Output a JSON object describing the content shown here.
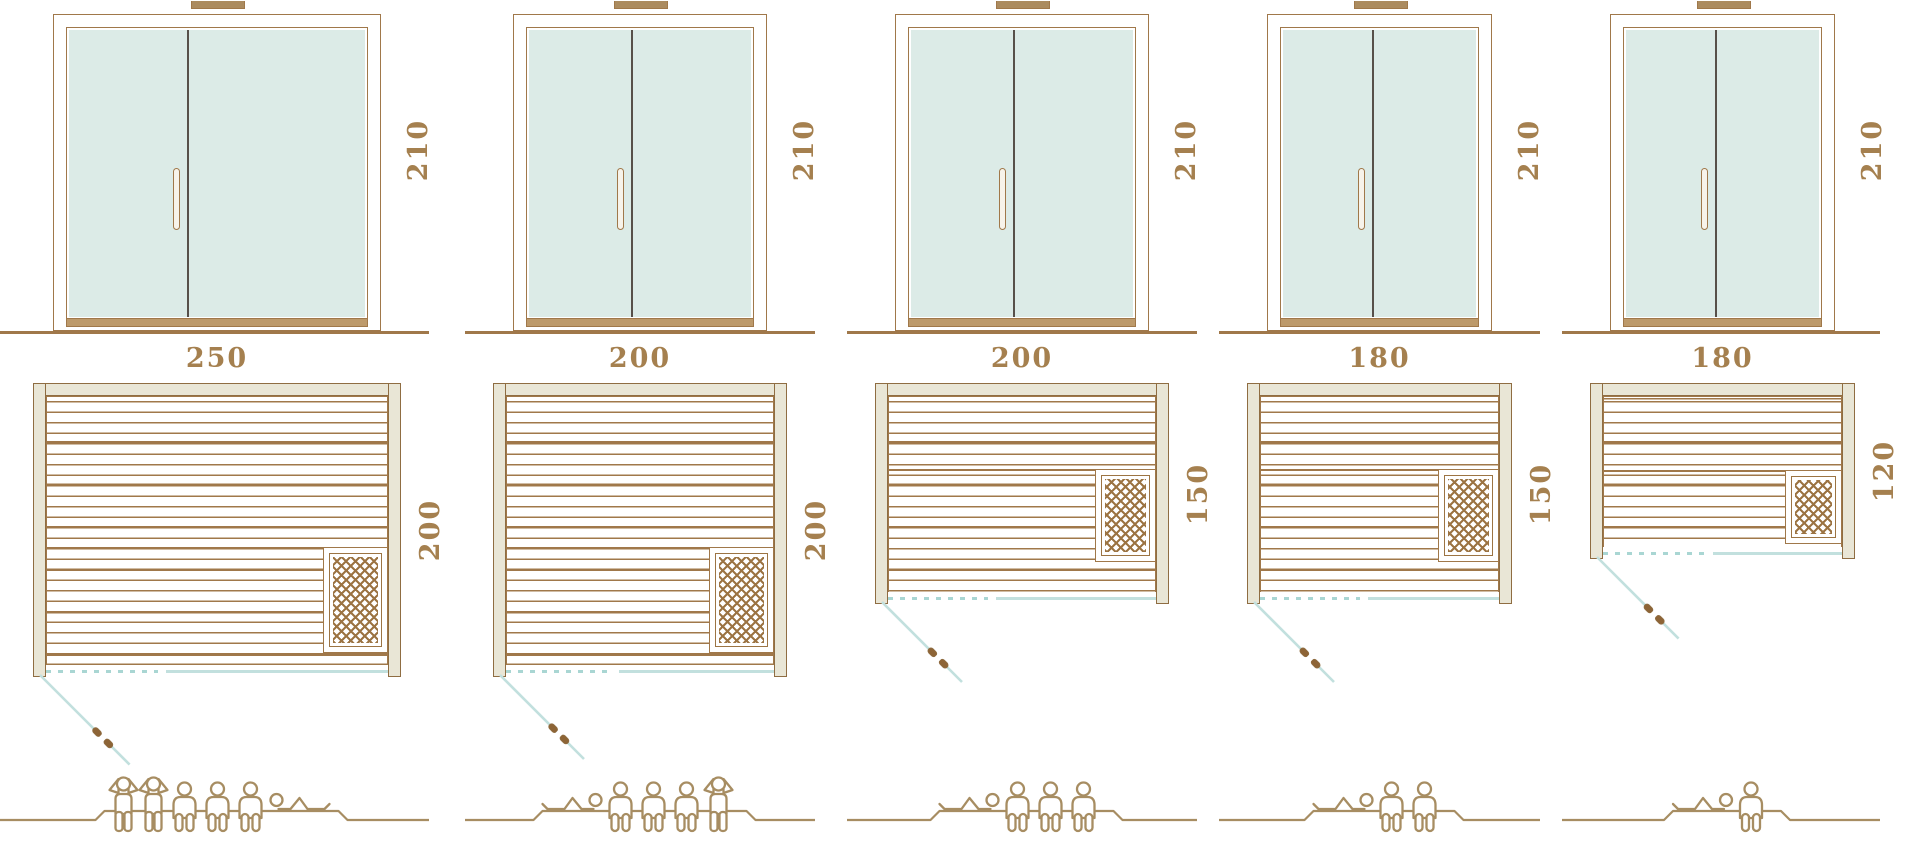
{
  "colors": {
    "line_brown": "#a0784a",
    "wall_stroke": "#8f6d42",
    "label_brown": "#a5804f",
    "glass_mint": "#dcebe7",
    "wall_beige": "#e9e6d6",
    "door_swing_teal": "#c2e0de",
    "door_opening_teal_dash": "#a9d6d3",
    "figure_tan": "#a78d62",
    "threshold_tan": "#bd9a6b",
    "door_divider_gray": "#57504a",
    "vent_brown": "#ab8b5f",
    "heater_lattice_brown": "#9c7443",
    "handle_grip_brown": "#8d6436"
  },
  "saunas": [
    {
      "id": "sauna-1",
      "elevation": {
        "height_label": "210",
        "height_cm": 210
      },
      "plan": {
        "width_label": "250",
        "depth_label": "200",
        "width_cm": 250,
        "depth_cm": 200,
        "heater_position": "bottom-right"
      },
      "capacity": {
        "total": 6,
        "standing": 2,
        "sitting": 3,
        "lying": 1,
        "figures": [
          "standing",
          "standing",
          "sitting",
          "sitting",
          "sitting",
          "lying-head-left"
        ]
      }
    },
    {
      "id": "sauna-2",
      "elevation": {
        "height_label": "210",
        "height_cm": 210
      },
      "plan": {
        "width_label": "200",
        "depth_label": "200",
        "width_cm": 200,
        "depth_cm": 200,
        "heater_position": "bottom-right"
      },
      "capacity": {
        "total": 5,
        "standing": 1,
        "sitting": 3,
        "lying": 1,
        "figures": [
          "lying-head-right",
          "sitting",
          "sitting",
          "sitting",
          "standing"
        ]
      }
    },
    {
      "id": "sauna-3",
      "elevation": {
        "height_label": "210",
        "height_cm": 210
      },
      "plan": {
        "width_label": "200",
        "depth_label": "150",
        "width_cm": 200,
        "depth_cm": 150,
        "heater_position": "right-middle"
      },
      "capacity": {
        "total": 4,
        "standing": 0,
        "sitting": 3,
        "lying": 1,
        "figures": [
          "lying-head-right",
          "sitting",
          "sitting",
          "sitting"
        ]
      }
    },
    {
      "id": "sauna-4",
      "elevation": {
        "height_label": "210",
        "height_cm": 210
      },
      "plan": {
        "width_label": "180",
        "depth_label": "150",
        "width_cm": 180,
        "depth_cm": 150,
        "heater_position": "right-middle"
      },
      "capacity": {
        "total": 3,
        "standing": 0,
        "sitting": 2,
        "lying": 1,
        "figures": [
          "lying-head-right",
          "sitting",
          "sitting"
        ]
      }
    },
    {
      "id": "sauna-5",
      "elevation": {
        "height_label": "210",
        "height_cm": 210
      },
      "plan": {
        "width_label": "180",
        "depth_label": "120",
        "width_cm": 180,
        "depth_cm": 120,
        "heater_position": "bottom-right"
      },
      "capacity": {
        "total": 2,
        "standing": 0,
        "sitting": 1,
        "lying": 1,
        "figures": [
          "lying-head-right",
          "sitting"
        ]
      }
    }
  ]
}
